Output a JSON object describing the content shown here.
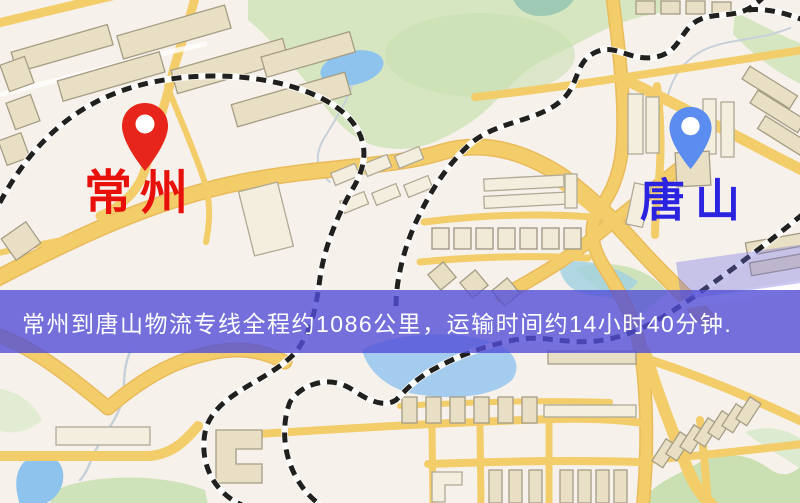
{
  "map": {
    "origin": {
      "label": "常州",
      "pin_color": "#e8251a",
      "label_color": "#e8100b"
    },
    "destination": {
      "label": "唐山",
      "pin_color": "#5b8df0",
      "label_color": "#2a23e0"
    },
    "banner": {
      "text": "常州到唐山物流专线全程约1086公里，运输时间约14小时40分钟.",
      "overlay_color": "#5250d7",
      "text_color": "#ffffff"
    },
    "route_info": {
      "distance_text": "约1086公里",
      "duration_text": "约14小时40分钟"
    },
    "palette": {
      "background": "#f7f1eb",
      "road": "#f3cd6a",
      "building": "#e9dfc4",
      "park": "#d5e6c0",
      "water": "#8ec3ee",
      "railway": "#20201e"
    }
  }
}
